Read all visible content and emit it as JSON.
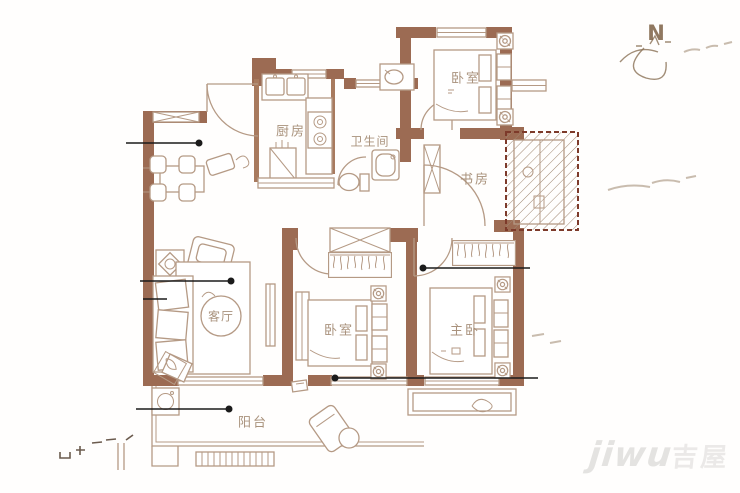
{
  "colors": {
    "wall": "#9c6b53",
    "furniture_line": "#b59a85",
    "room_label": "#a0876f",
    "leader_line": "#1b1b1b",
    "shaft_border": "#7d3a2a",
    "watermark": "#b9b7b4"
  },
  "compass": {
    "label": "N"
  },
  "rooms": [
    {
      "id": "kitchen",
      "label": "厨房"
    },
    {
      "id": "bathroom",
      "label": "卫生间"
    },
    {
      "id": "bedroom-north",
      "label": "卧室"
    },
    {
      "id": "study",
      "label": "书房"
    },
    {
      "id": "living-room",
      "label": "客厅"
    },
    {
      "id": "bedroom-middle",
      "label": "卧室"
    },
    {
      "id": "master-bedroom",
      "label": "主卧"
    },
    {
      "id": "balcony",
      "label": "阳台"
    }
  ],
  "watermark": {
    "latin": "jiwu",
    "cjk": "吉屋"
  }
}
